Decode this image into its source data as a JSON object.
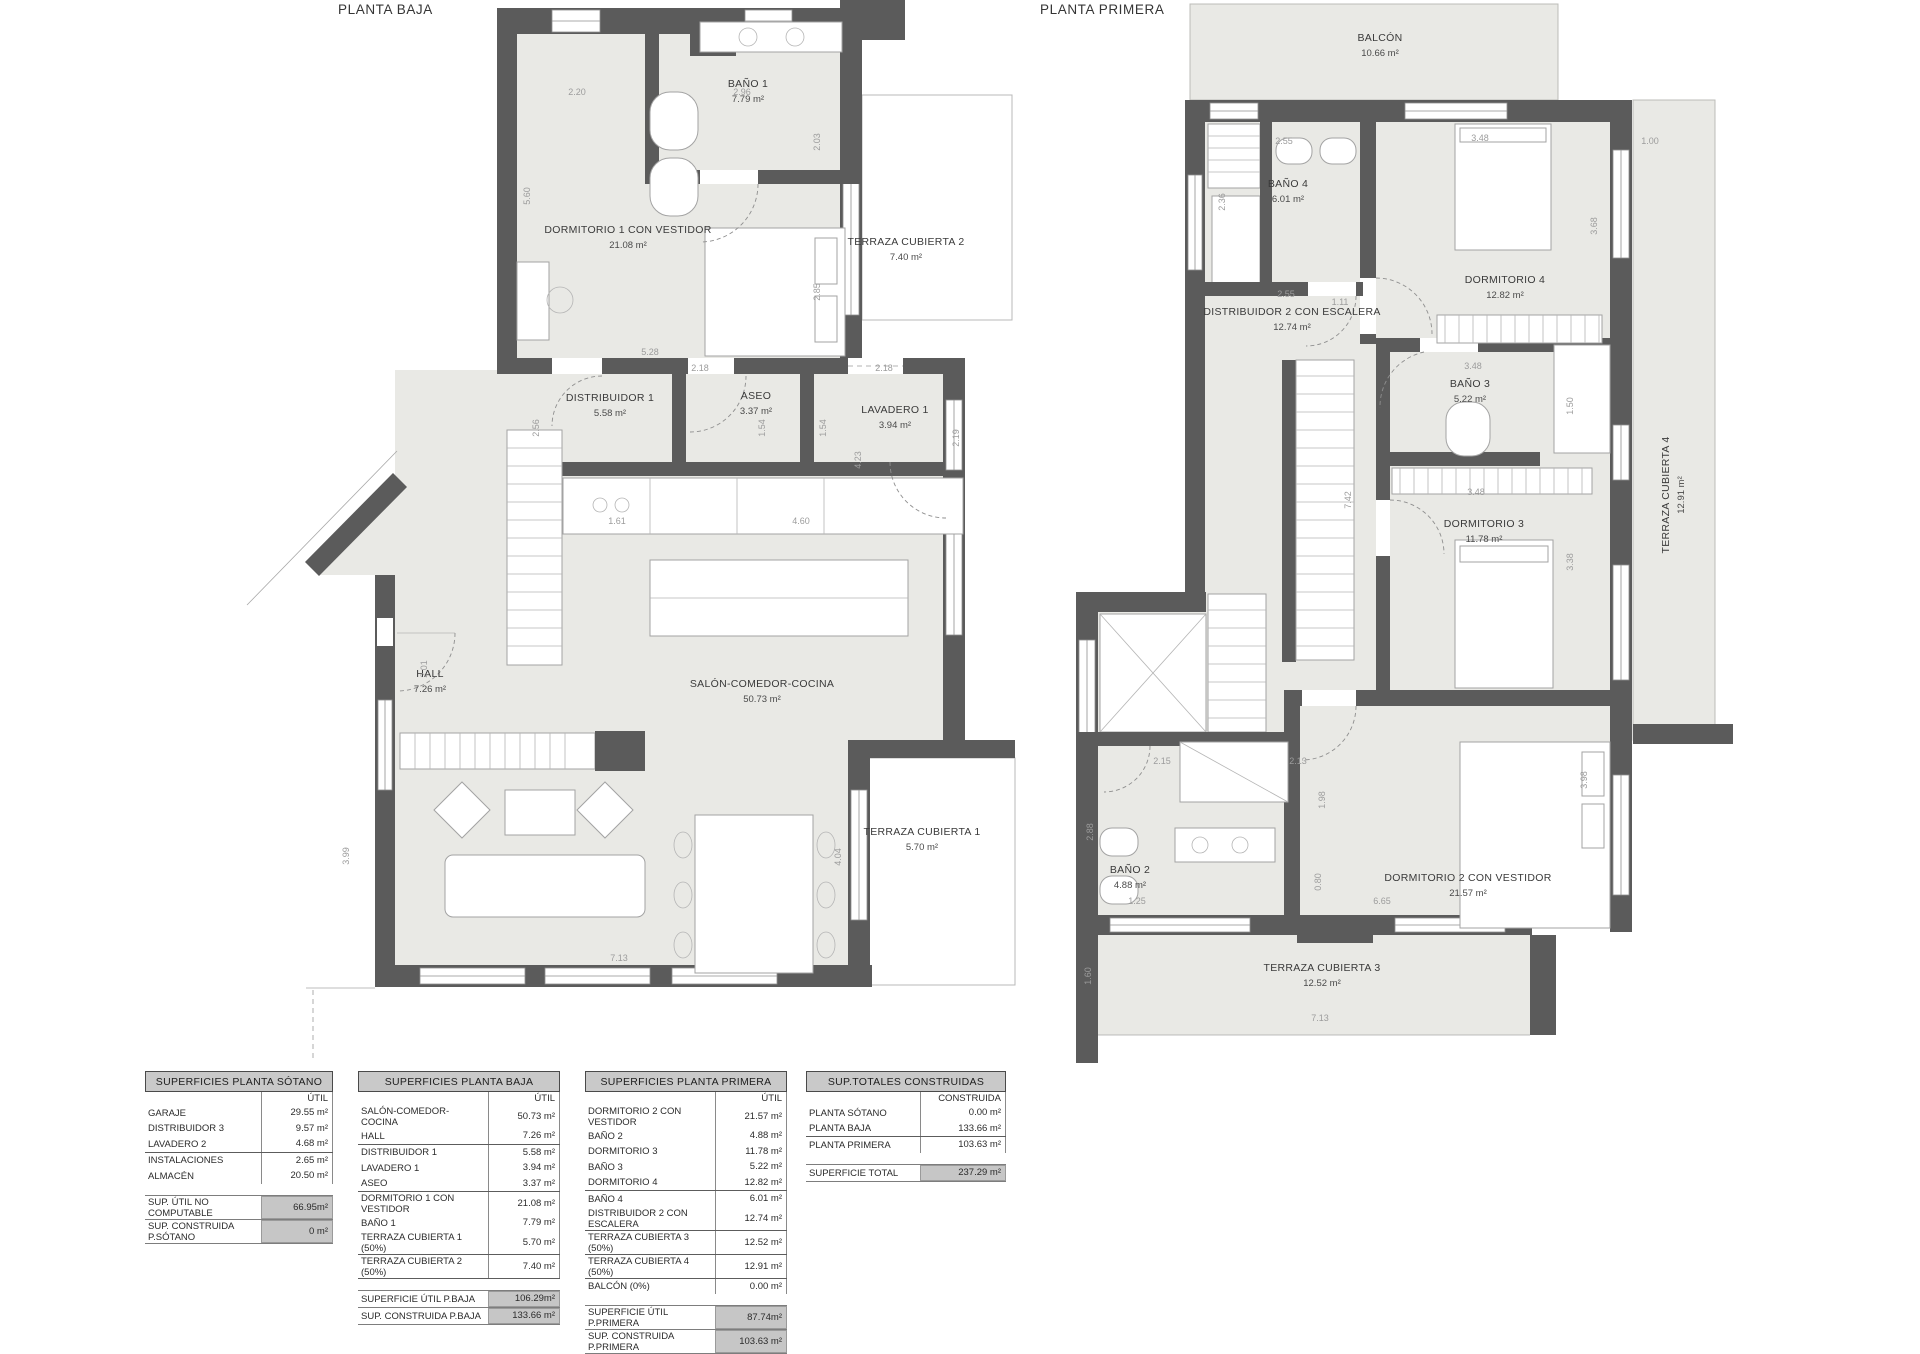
{
  "titles": {
    "baja": "PLANTA BAJA",
    "primera": "PLANTA PRIMERA"
  },
  "plan_baja": {
    "rooms": [
      {
        "n": "BAÑO 1",
        "a": "7.79 m²"
      },
      {
        "n": "DORMITORIO 1 CON VESTIDOR",
        "a": "21.08 m²"
      },
      {
        "n": "TERRAZA CUBIERTA 2",
        "a": "7.40 m²"
      },
      {
        "n": "DISTRIBUIDOR 1",
        "a": "5.58 m²"
      },
      {
        "n": "ASEO",
        "a": "3.37 m²"
      },
      {
        "n": "LAVADERO 1",
        "a": "3.94 m²"
      },
      {
        "n": "HALL",
        "a": "7.26 m²"
      },
      {
        "n": "SALÓN-COMEDOR-COCINA",
        "a": "50.73 m²"
      },
      {
        "n": "TERRAZA CUBIERTA 1",
        "a": "5.70 m²"
      }
    ],
    "dims": [
      "2.20",
      "2.96",
      "5.60",
      "2.03",
      "2.85",
      "5.28",
      "2.18",
      "1.54",
      "2.18",
      "1.54",
      "2.19",
      "2.56",
      "1.61",
      "4.60",
      "4.23",
      "2.01",
      "3.99",
      "4.04",
      "7.13"
    ]
  },
  "plan_primera": {
    "rooms": [
      {
        "n": "BALCÓN",
        "a": "10.66 m²"
      },
      {
        "n": "BAÑO 4",
        "a": "6.01 m²"
      },
      {
        "n": "DORMITORIO 4",
        "a": "12.82 m²"
      },
      {
        "n": "DISTRIBUIDOR 2 CON ESCALERA",
        "a": "12.74 m²"
      },
      {
        "n": "BAÑO 3",
        "a": "5.22 m²"
      },
      {
        "n": "DORMITORIO 3",
        "a": "11.78 m²"
      },
      {
        "n": "TERRAZA CUBIERTA 4",
        "a": "12.91 m²"
      },
      {
        "n": "BAÑO 2",
        "a": "4.88 m²"
      },
      {
        "n": "DORMITORIO 2 CON VESTIDOR",
        "a": "21.57 m²"
      },
      {
        "n": "TERRAZA CUBIERTA 3",
        "a": "12.52 m²"
      }
    ],
    "dims": [
      "2.55",
      "3.48",
      "1.00",
      "2.36",
      "3.68",
      "2.55",
      "1.11",
      "7.42",
      "3.48",
      "1.50",
      "3.48",
      "3.38",
      "2.15",
      "2.13",
      "1.98",
      "0.80",
      "6.65",
      "2.88",
      "1.25",
      "3.98",
      "1.60",
      "7.13"
    ]
  },
  "tables": {
    "sotano": {
      "title": "SUPERFICIES PLANTA SÓTANO",
      "col": "ÚTIL",
      "rows": [
        {
          "l": "GARAJE",
          "v": "29.55 m²"
        },
        {
          "l": "DISTRIBUIDOR 3",
          "v": "9.57 m²"
        },
        {
          "l": "LAVADERO 2",
          "v": "4.68 m²"
        },
        {
          "l": "INSTALACIONES",
          "v": "2.65 m²"
        },
        {
          "l": "ALMACÉN",
          "v": "20.50 m²"
        }
      ],
      "totals": [
        {
          "l": "SUP. ÚTIL NO COMPUTABLE",
          "v": "66.95m²"
        },
        {
          "l": "SUP. CONSTRUIDA P.SÓTANO",
          "v": "0 m²"
        }
      ]
    },
    "baja": {
      "title": "SUPERFICIES PLANTA BAJA",
      "col": "ÚTIL",
      "rows": [
        {
          "l": "SALÓN-COMEDOR-COCINA",
          "v": "50.73 m²"
        },
        {
          "l": "HALL",
          "v": "7.26 m²"
        },
        {
          "l": "DISTRIBUIDOR 1",
          "v": "5.58 m²"
        },
        {
          "l": "LAVADERO 1",
          "v": "3.94 m²"
        },
        {
          "l": "ASEO",
          "v": "3.37 m²"
        },
        {
          "l": "DORMITORIO 1 CON VESTIDOR",
          "v": "21.08 m²"
        },
        {
          "l": "BAÑO 1",
          "v": "7.79 m²"
        },
        {
          "l": "TERRAZA CUBIERTA 1 (50%)",
          "v": "5.70 m²"
        },
        {
          "l": "TERRAZA CUBIERTA 2 (50%)",
          "v": "7.40 m²"
        }
      ],
      "totals": [
        {
          "l": "SUPERFICIE ÚTIL P.BAJA",
          "v": "106.29m²"
        },
        {
          "l": "SUP. CONSTRUIDA P.BAJA",
          "v": "133.66 m²"
        }
      ]
    },
    "primera": {
      "title": "SUPERFICIES PLANTA PRIMERA",
      "col": "ÚTIL",
      "rows": [
        {
          "l": "DORMITORIO 2 CON VESTIDOR",
          "v": "21.57 m²"
        },
        {
          "l": "BAÑO 2",
          "v": "4.88 m²"
        },
        {
          "l": "DORMITORIO 3",
          "v": "11.78 m²"
        },
        {
          "l": "BAÑO 3",
          "v": "5.22 m²"
        },
        {
          "l": "DORMITORIO 4",
          "v": "12.82 m²"
        },
        {
          "l": "BAÑO 4",
          "v": "6.01 m²"
        },
        {
          "l": "DISTRIBUIDOR 2 CON ESCALERA",
          "v": "12.74 m²"
        },
        {
          "l": "TERRAZA CUBIERTA 3 (50%)",
          "v": "12.52 m²"
        },
        {
          "l": "TERRAZA CUBIERTA 4 (50%)",
          "v": "12.91 m²"
        },
        {
          "l": "BALCÓN (0%)",
          "v": "0.00 m²"
        }
      ],
      "totals": [
        {
          "l": "SUPERFICIE ÚTIL P.PRIMERA",
          "v": "87.74m²"
        },
        {
          "l": "SUP. CONSTRUIDA P.PRIMERA",
          "v": "103.63 m²"
        }
      ]
    },
    "totales": {
      "title": "SUP.TOTALES CONSTRUIDAS",
      "col": "CONSTRUIDA",
      "rows": [
        {
          "l": "PLANTA SÓTANO",
          "v": "0.00 m²"
        },
        {
          "l": "PLANTA BAJA",
          "v": "133.66 m²"
        },
        {
          "l": "PLANTA PRIMERA",
          "v": "103.63 m²"
        }
      ],
      "totals": [
        {
          "l": "SUPERFICIE TOTAL",
          "v": "237.29 m²"
        }
      ]
    }
  },
  "colors": {
    "wall": "#5b5b5b",
    "floor": "#e9e9e5",
    "table_header": "#c9c9c9"
  }
}
